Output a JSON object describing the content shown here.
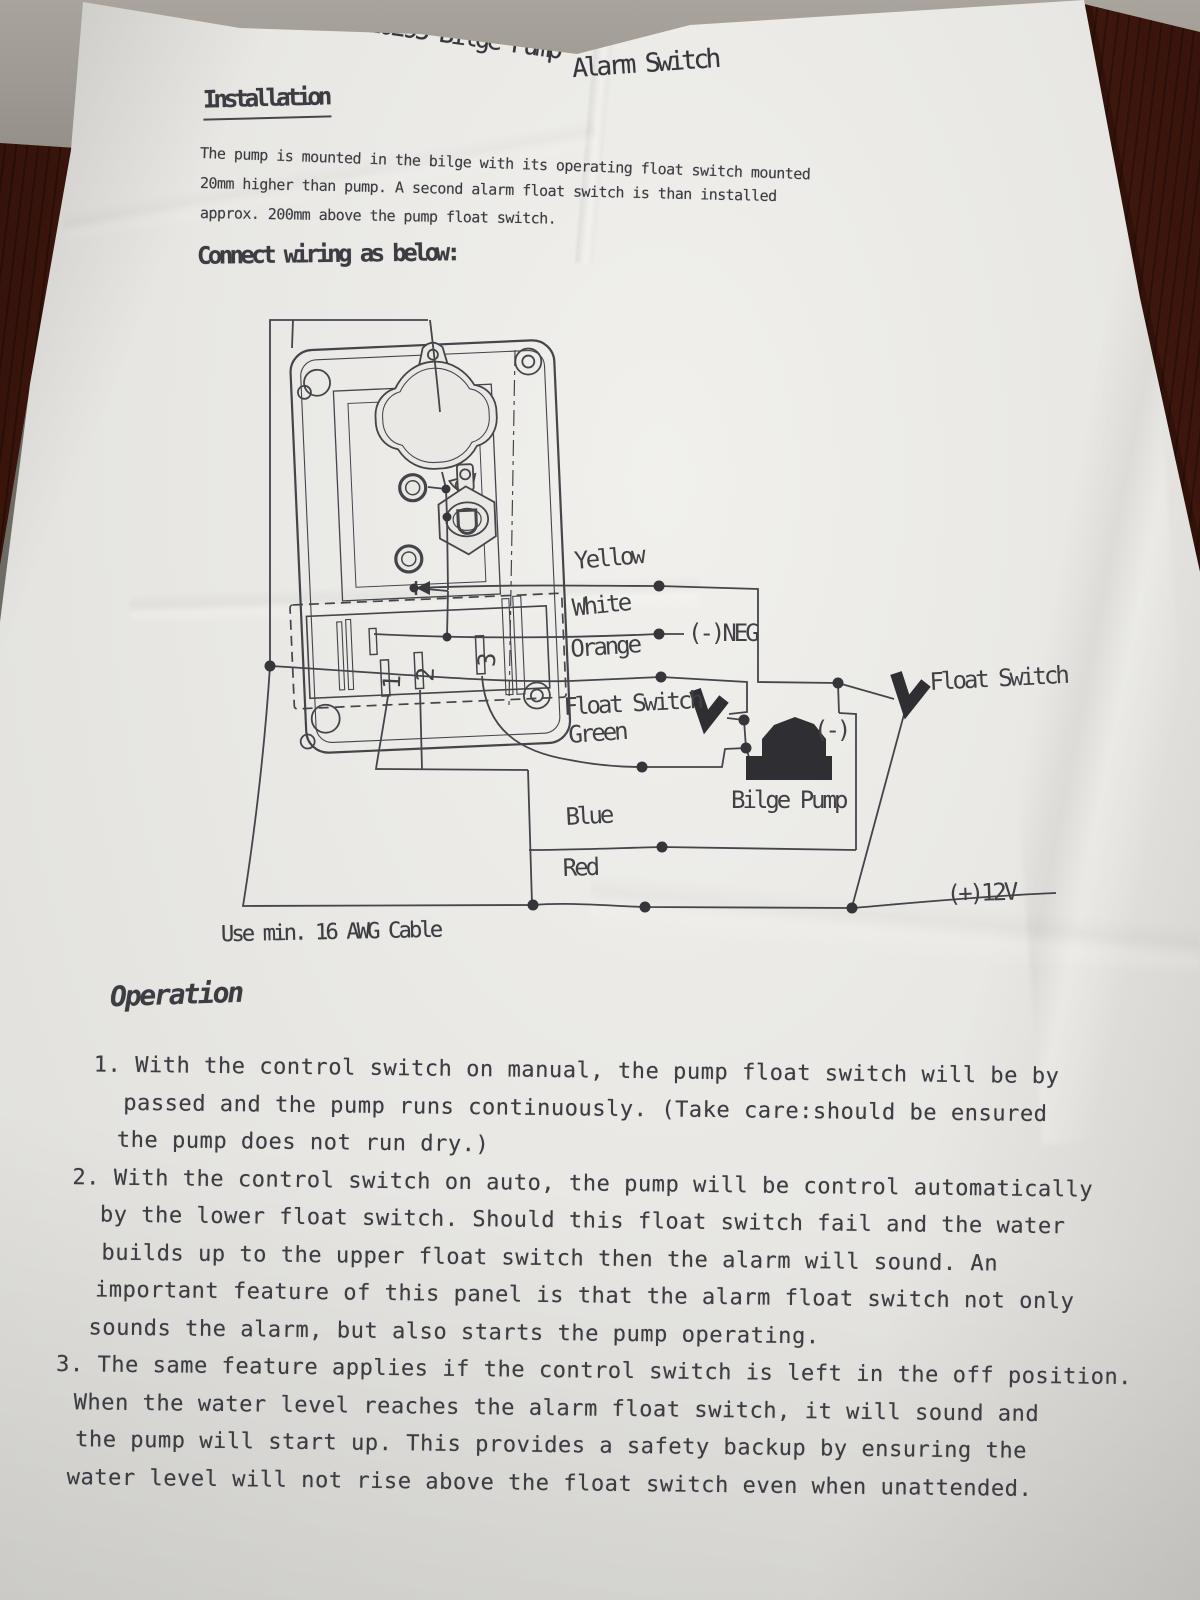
{
  "doc": {
    "title": {
      "part1": "10295 Bilge Pump",
      "part2": "Alarm Switch"
    },
    "installation": {
      "heading": "Installation",
      "lines": [
        "The pump is mounted in the bilge with its operating float switch mounted",
        "20mm higher than pump. A second alarm float switch is than installed",
        "approx. 200mm above the pump float switch."
      ]
    },
    "connect_heading": "Connect wiring as below:",
    "diagram": {
      "wire_labels": {
        "yellow": "Yellow",
        "white": "White",
        "orange": "Orange",
        "float_switch_lower": "Float Switch",
        "green": "Green",
        "blue": "Blue",
        "red": "Red"
      },
      "neg_label": "(-)NEG",
      "float_switch_upper": "Float Switch",
      "pump_neg_label": "(-)",
      "pump_label": "Bilge Pump",
      "power_label": "(+)12V",
      "terminal_labels": [
        "1",
        "2",
        "3"
      ]
    },
    "cable_note": "Use min. 16 AWG Cable",
    "operation": {
      "heading": "Operation",
      "items": [
        {
          "lines": [
            "1. With the control switch on manual, the pump float switch will be by",
            "passed and the pump runs continuously. (Take care:should be ensured",
            "the pump does not run dry.)"
          ]
        },
        {
          "lines": [
            "2. With the control switch on auto, the pump will be control automatically",
            "by the lower float switch. Should this float switch fail and the water",
            "builds up to the upper float switch then the alarm will sound. An",
            "important feature of this panel is that the alarm float switch not only",
            "sounds the alarm, but also starts the pump operating."
          ]
        },
        {
          "lines": [
            "3. The same feature applies if the control switch is left in the off position.",
            "When the water level reaches the alarm float switch, it will sound and",
            "the pump will start up. This provides a safety backup by ensuring the",
            "water level will not rise above the float switch even when unattended."
          ]
        }
      ]
    }
  }
}
